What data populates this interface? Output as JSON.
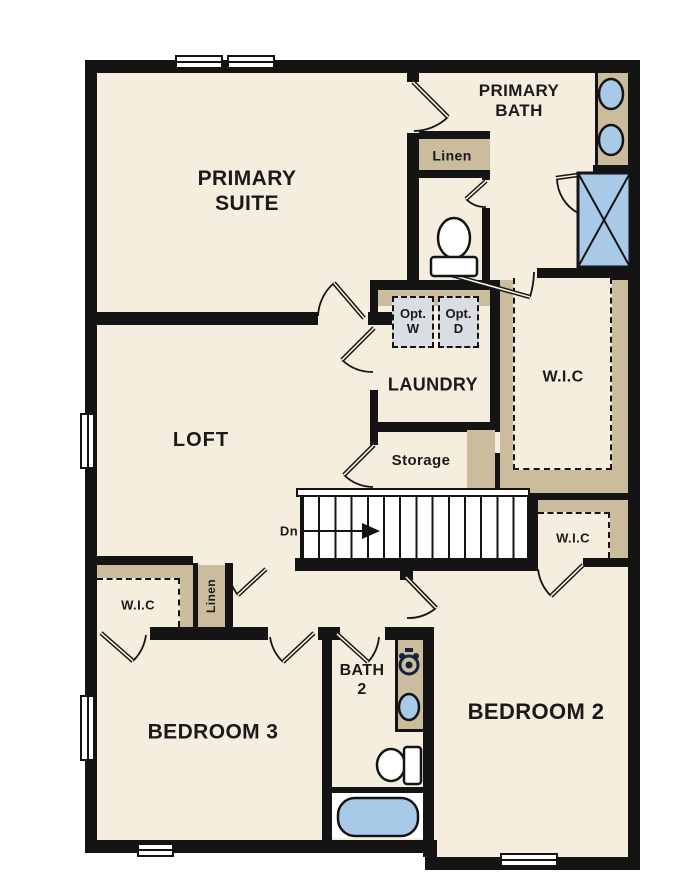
{
  "rooms": {
    "primary_suite": {
      "label": "PRIMARY SUITE"
    },
    "primary_bath": {
      "label": "PRIMARY BATH"
    },
    "loft": {
      "label": "LOFT"
    },
    "laundry": {
      "label": "LAUNDRY"
    },
    "storage": {
      "label": "Storage"
    },
    "bedroom2": {
      "label": "BEDROOM 2"
    },
    "bedroom3": {
      "label": "BEDROOM 3"
    },
    "bath2": {
      "label": "BATH 2"
    },
    "wic_primary": {
      "label": "W.I.C"
    },
    "wic_bedroom2": {
      "label": "W.I.C"
    },
    "wic_bedroom3": {
      "label": "W.I.C"
    },
    "linen_bath": {
      "label": "Linen"
    },
    "linen_hall": {
      "label": "Linen"
    }
  },
  "stairs": {
    "direction_label": "Dn"
  },
  "appliances": {
    "washer": "Opt. W",
    "dryer": "Opt. D"
  },
  "colors": {
    "floor": "#f5edde",
    "wall": "#141414",
    "tan": "#cbbc9e",
    "fixture": "#a9c9e9",
    "optfill": "#dadde2",
    "ink": "#1a1a1a",
    "navy": "#15233f",
    "winwhite": "#ffffff"
  }
}
